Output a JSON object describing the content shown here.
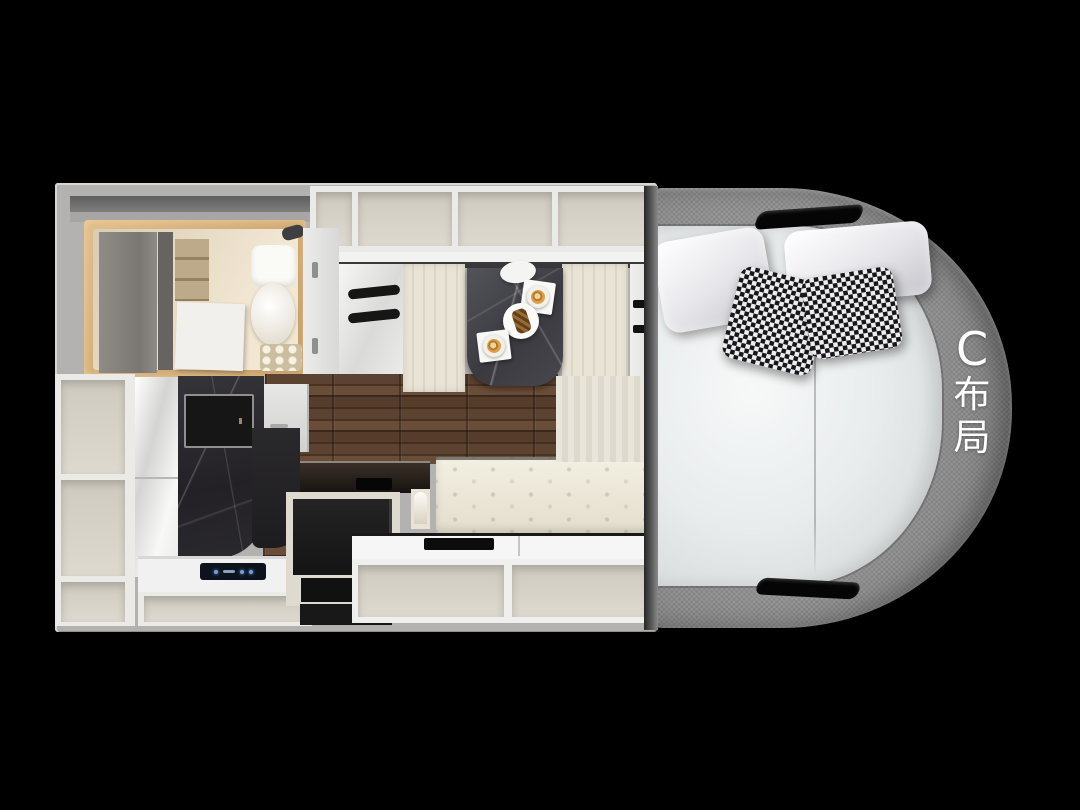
{
  "scene": {
    "description": "Top-down 3D floor plan of a motorhome interior, layout variant C",
    "layout_label": {
      "text": "C布局",
      "chars": [
        "C",
        "布",
        "局"
      ]
    }
  },
  "colors": {
    "background": "#000000",
    "wall_gray": "#b3b2b0",
    "fabric_gray": "#8b8b8b",
    "mattress_white": "#e9ecec",
    "cabinet_white": "#f2f2f1",
    "interior_cream": "#ded9cf",
    "bench_cream": "#e9e4d6",
    "wood_dark": "#4c3627",
    "marble_black": "#232125",
    "table_marble": "#3a3a40",
    "accent_warmlight": "#e0bd8c",
    "houndstooth_black": "#17171b",
    "appliance_black": "#141414",
    "panel_blue": "#6f9fe0",
    "coffee_gold": "#d9a24b",
    "label_white": "#ffffff"
  }
}
